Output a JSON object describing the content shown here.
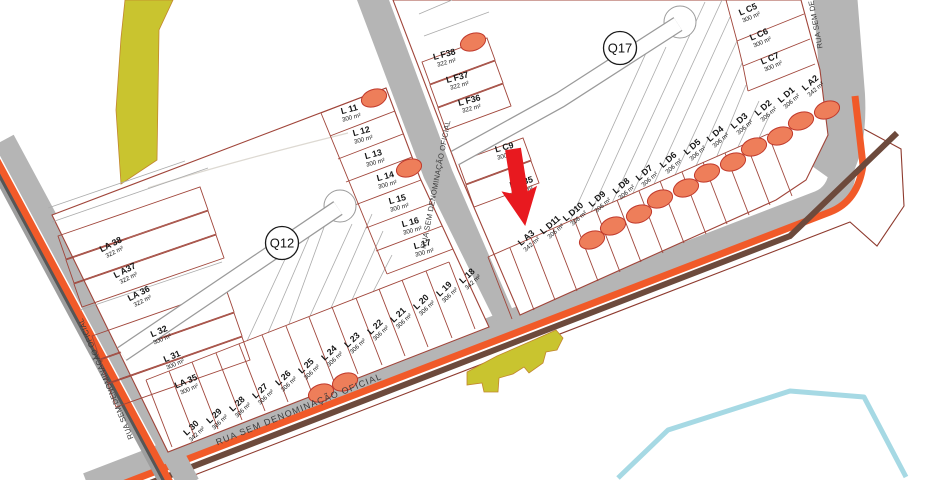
{
  "streets": {
    "bottom_label": "RUA SEM DENOMINAÇÃO OFICIAL",
    "middle_label": "RUA SEM DENOMINAÇÃO OFICIAL",
    "left_label": "RUA SEM DENOMINAÇÃO OFICIAL",
    "top_right_label": "RUA SEM DE"
  },
  "quadras": {
    "q12_label": "Q12",
    "q17_label": "Q17"
  },
  "q12": {
    "col": [
      {
        "label": "L 11",
        "area": "300 m²"
      },
      {
        "label": "L 12",
        "area": "300 m²"
      },
      {
        "label": "L 13",
        "area": "300 m²"
      },
      {
        "label": "L 14",
        "area": "300 m²"
      },
      {
        "label": "L 15",
        "area": "300 m²"
      },
      {
        "label": "L 16",
        "area": "300 m²"
      },
      {
        "label": "L 17",
        "area": "300 m²"
      }
    ],
    "la_row": [
      {
        "label": "LA 38",
        "area": "322 m²"
      },
      {
        "label": "L A37",
        "area": "322 m²"
      },
      {
        "label": "LA 36",
        "area": "322 m²"
      }
    ],
    "mid_row": [
      {
        "label": "L 32",
        "area": "300 m²"
      },
      {
        "label": "L 31",
        "area": "300 m²"
      },
      {
        "label": "LA 35",
        "area": "300 m²"
      }
    ],
    "bottom_row": [
      {
        "label": "L 30",
        "area": "342 m²"
      },
      {
        "label": "L 29",
        "area": "306 m²"
      },
      {
        "label": "L 28",
        "area": "306 m²"
      },
      {
        "label": "L 27",
        "area": "306 m²"
      },
      {
        "label": "L 26",
        "area": "306 m²"
      },
      {
        "label": "L 25",
        "area": "306 m²"
      },
      {
        "label": "L 24",
        "area": "306 m²"
      },
      {
        "label": "L 23",
        "area": "306 m²"
      },
      {
        "label": "L 22",
        "area": "306 m²"
      },
      {
        "label": "L 21",
        "area": "306 m²"
      },
      {
        "label": "L 20",
        "area": "306 m²"
      },
      {
        "label": "L 19",
        "area": "306 m²"
      },
      {
        "label": "L 18",
        "area": "342 m²"
      }
    ]
  },
  "q17": {
    "f_col": [
      {
        "label": "L F38",
        "area": "322 m²"
      },
      {
        "label": "L F37",
        "area": "322 m²"
      },
      {
        "label": "L F36",
        "area": "322 m²"
      }
    ],
    "c_col": [
      {
        "label": "L C9",
        "area": "300 m²"
      },
      {
        "label": "L C35",
        "area": "300 m²"
      }
    ],
    "c_col_tr": [
      {
        "label": "L C5",
        "area": "300 m²"
      },
      {
        "label": "L C6",
        "area": "300 m²"
      },
      {
        "label": "L C7",
        "area": "300 m²"
      }
    ],
    "bottom_row": [
      {
        "label": "L A3",
        "area": "342 m²"
      },
      {
        "label": "L D11",
        "area": "306 m²"
      },
      {
        "label": "L D10",
        "area": "306 m²"
      },
      {
        "label": "L D9",
        "area": "306 m²"
      },
      {
        "label": "L D8",
        "area": "306 m²"
      },
      {
        "label": "L D7",
        "area": "306 m²"
      },
      {
        "label": "L D6",
        "area": "306 m²"
      },
      {
        "label": "L D5",
        "area": "306 m²"
      },
      {
        "label": "L D4",
        "area": "306 m²"
      },
      {
        "label": "L D3",
        "area": "306 m²"
      },
      {
        "label": "L D2",
        "area": "306 m²"
      },
      {
        "label": "L D1",
        "area": "306 m²"
      },
      {
        "label": "L A2",
        "area": "342 m²"
      }
    ]
  },
  "colors": {
    "street_gray": "#b5b5b5",
    "lot_line_red": "#a0453a",
    "highlight_ellipse": "#ee7e5a",
    "accent_orange": "#f15a29",
    "accent_brown": "#6d4a3c",
    "area_yellow": "#c9c42f",
    "water_blue": "#a6d9e4",
    "arrow_red": "#e8191f"
  }
}
